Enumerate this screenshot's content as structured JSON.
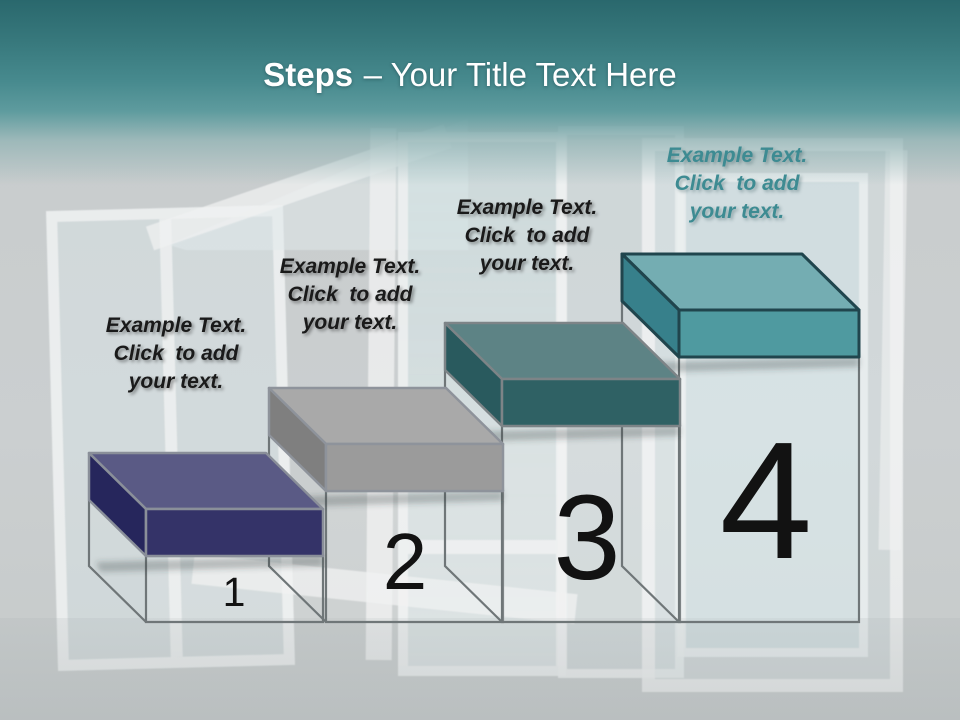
{
  "title": {
    "bold": "Steps",
    "rest": "– Your Title Text Here"
  },
  "palette": {
    "header_top": "#2a686d",
    "header_mid": "#478a8e",
    "background": "#c8cccc",
    "title_text": "#ffffff",
    "label_text": "#1a1a1a",
    "label_text_step4": "#3d8b92",
    "wireframe": "#6f7678",
    "number": "#121212"
  },
  "steps": [
    {
      "number": "1",
      "label": {
        "line1": "Example Text.",
        "line2": "Click  to add",
        "line3": "your text."
      },
      "colors": {
        "top": "#5a5a85",
        "front": "#343368",
        "side": "#26265c",
        "edge": "#8a8f99"
      }
    },
    {
      "number": "2",
      "label": {
        "line1": "Example Text.",
        "line2": "Click  to add",
        "line3": "your text."
      },
      "colors": {
        "top": "#a9a9a9",
        "front": "#9b9b9b",
        "side": "#7f7f7f",
        "edge": "#8e939b"
      }
    },
    {
      "number": "3",
      "label": {
        "line1": "Example Text.",
        "line2": "Click  to add",
        "line3": "your text."
      },
      "colors": {
        "top": "#5d8385",
        "front": "#2f6164",
        "side": "#295a5e",
        "edge": "#7d8487"
      }
    },
    {
      "number": "4",
      "label": {
        "line1": "Example Text.",
        "line2": "Click  to add",
        "line3": "your text."
      },
      "colors": {
        "top": "#74adb2",
        "front": "#4f9aa0",
        "side": "#37808b",
        "edge": "#20454d"
      }
    }
  ]
}
